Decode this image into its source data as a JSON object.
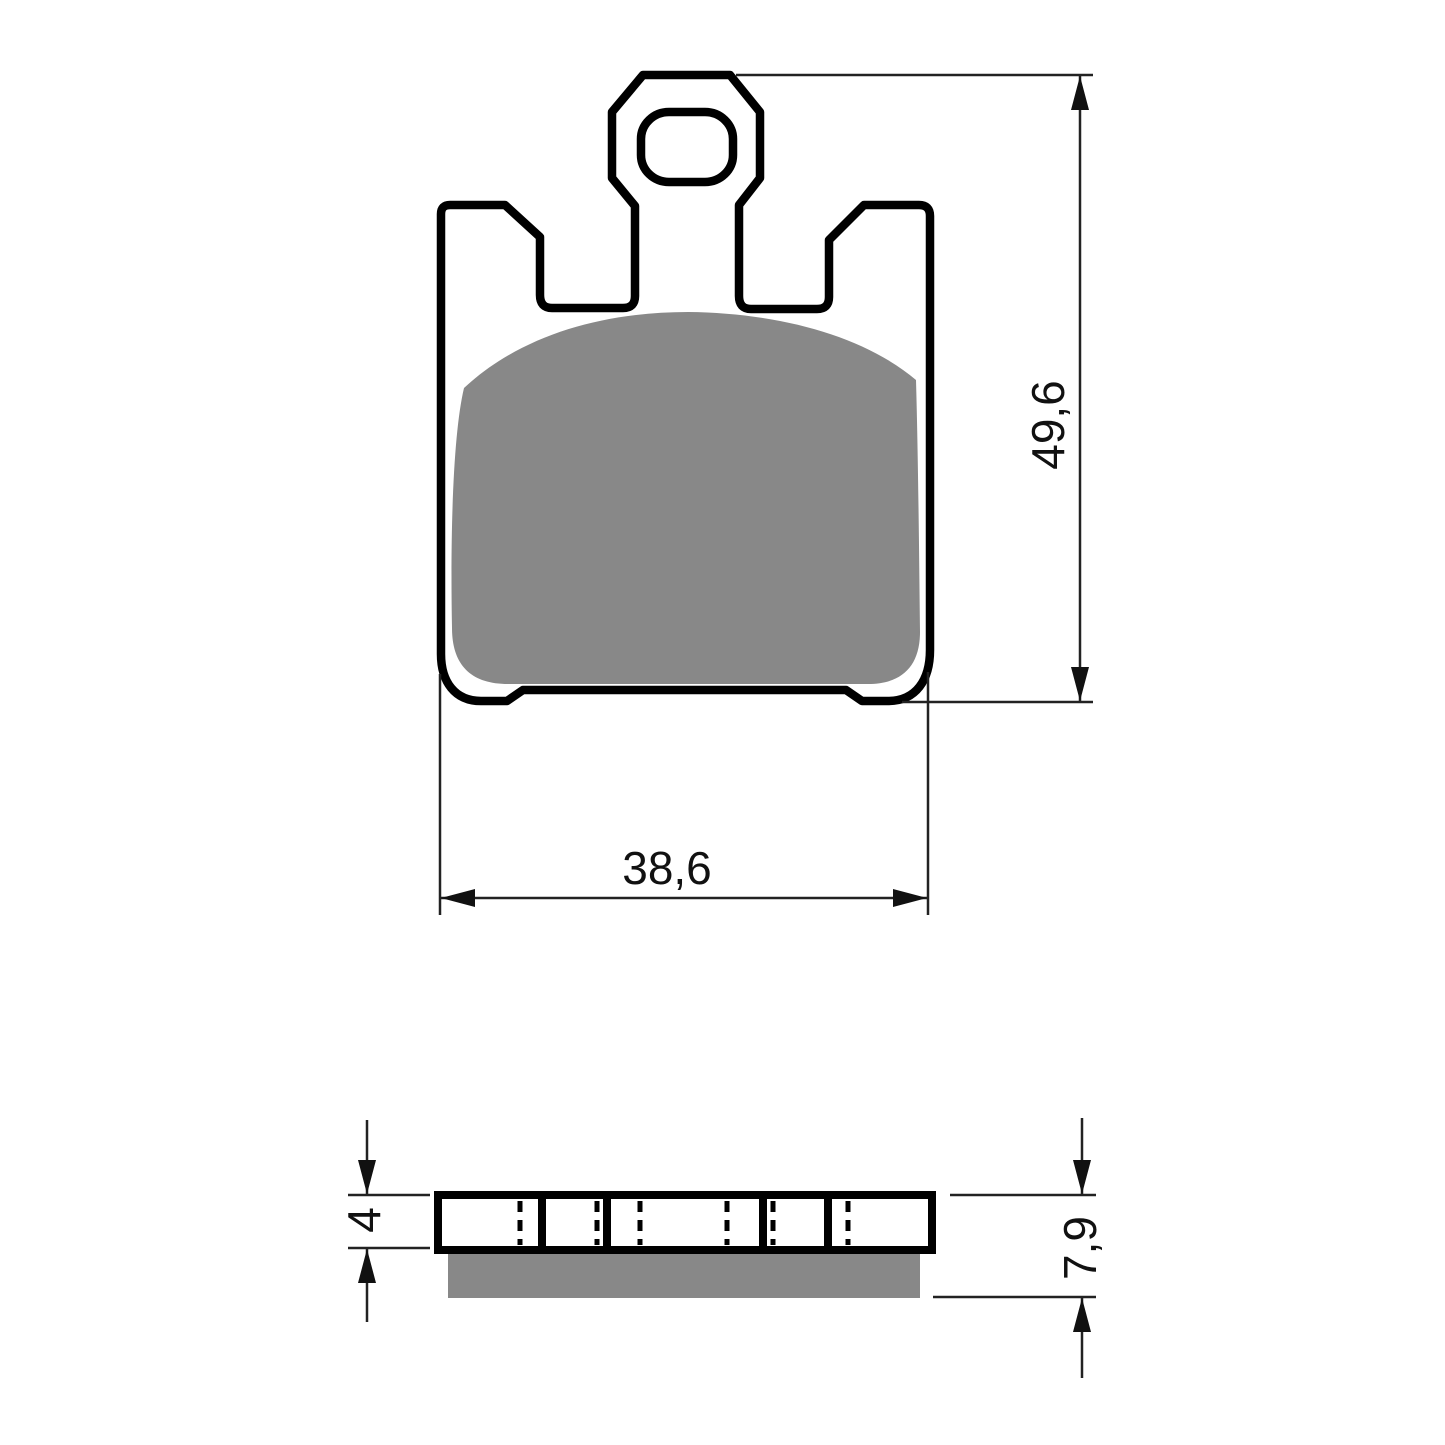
{
  "drawing": {
    "labels": {
      "height": "49,6",
      "width": "38,6",
      "backplate_thickness": "4",
      "total_thickness": "7,9"
    },
    "colors": {
      "outline": "#000000",
      "friction_material": "#888888",
      "dimension_lines": "#222222",
      "background": "#ffffff"
    }
  }
}
